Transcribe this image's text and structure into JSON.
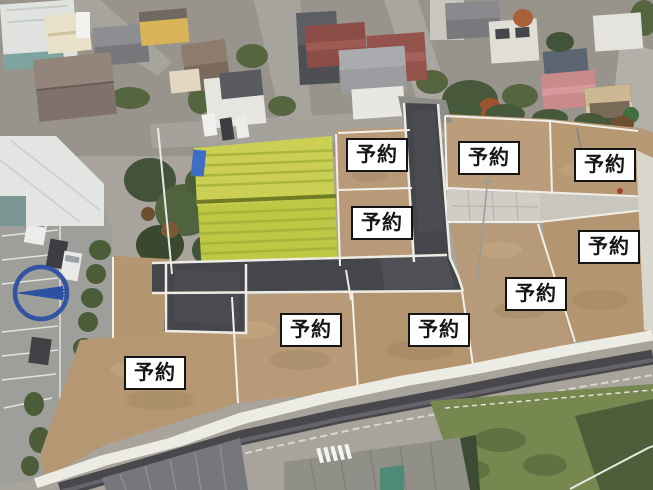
{
  "overlay": {
    "lot_labels": [
      "予約",
      "予約",
      "予約",
      "予約",
      "予約",
      "予約",
      "予約",
      "予約",
      "予約"
    ],
    "reserved_lot_count": 9,
    "compass_letter": "N"
  },
  "scene": {
    "type": "aerial-drone-photo",
    "colors": {
      "label_background": "#ffffff",
      "label_border": "#151515",
      "label_text": "#151515",
      "compass_blue": "#2c50a2",
      "new_asphalt": "#45464c",
      "dirt_lot": "#b79a79",
      "rice_field": "#c2c94e",
      "concrete_driveway": "#d0cdc6",
      "retaining_wall": "#ecebe4"
    }
  }
}
